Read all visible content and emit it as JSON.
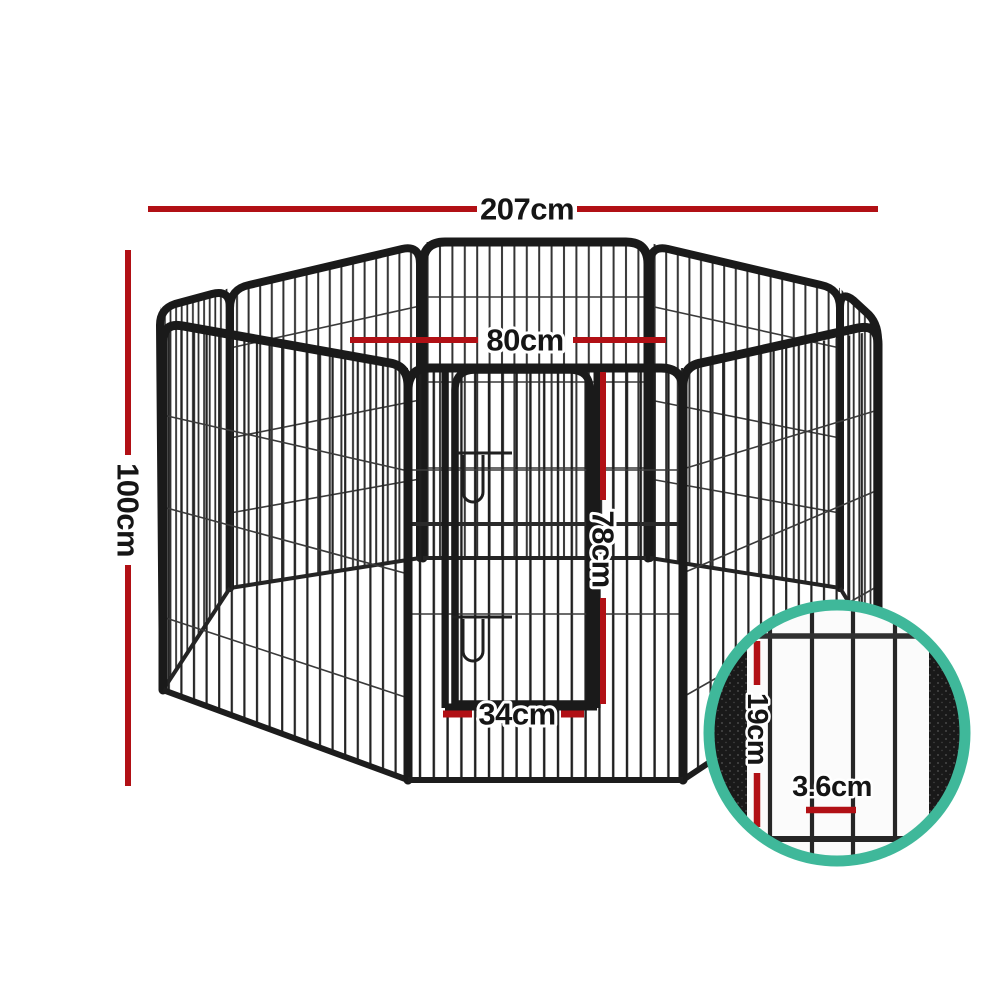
{
  "image": {
    "type": "product-dimension-photo",
    "subject": "8 panel pet dog playpen with gate",
    "background": "#ffffff"
  },
  "colors": {
    "dimension_red": "#b11015",
    "magnifier_teal": "#3fb89a",
    "label_text": "#151515",
    "frame_dark": "#1a1a1a"
  },
  "dimensions": {
    "overall_width": "207cm",
    "overall_height": "100cm",
    "panel_width": "80cm",
    "gate_height": "78cm",
    "gate_width": "34cm"
  },
  "magnifier_detail": {
    "bar_section_height": "19cm",
    "bar_gap": "3.6cm"
  }
}
